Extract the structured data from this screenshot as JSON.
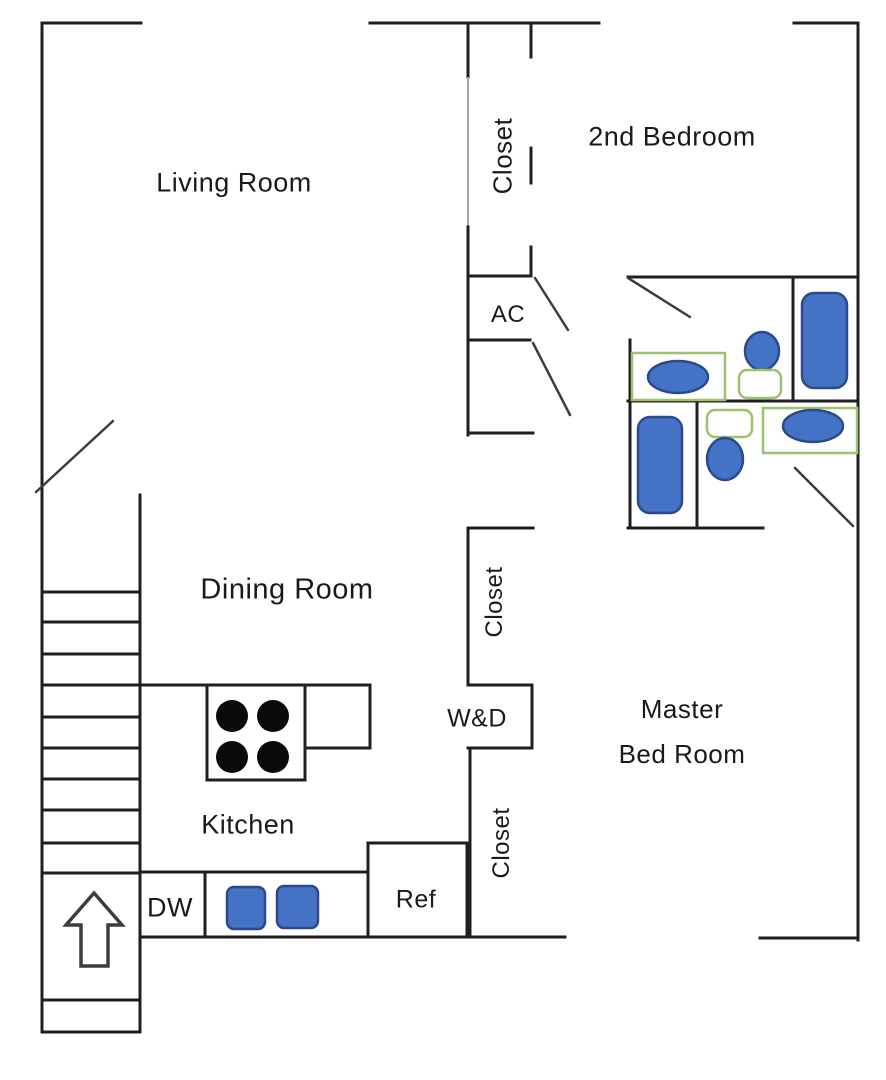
{
  "colors": {
    "background": "#ffffff",
    "wall": "#1f1f1f",
    "wall_light": "#a6a6a6",
    "door": "#3d3d3d",
    "fixture_blue_fill": "#4472c4",
    "fixture_blue_stroke": "#2a4a8b",
    "fixture_green_stroke": "#9cc26d",
    "burner_black": "#0a0a0a"
  },
  "rooms": {
    "living_room": "Living Room",
    "second_bedroom": "2nd Bedroom",
    "dining_room": "Dining Room",
    "kitchen": "Kitchen",
    "master_bedroom_line1": "Master",
    "master_bedroom_line2": "Bed Room"
  },
  "closets": {
    "top": "Closet",
    "middle": "Closet",
    "bottom": "Closet"
  },
  "labels": {
    "ac": "AC",
    "washer_dryer": "W&D",
    "dishwasher": "DW",
    "refrigerator": "Ref"
  }
}
